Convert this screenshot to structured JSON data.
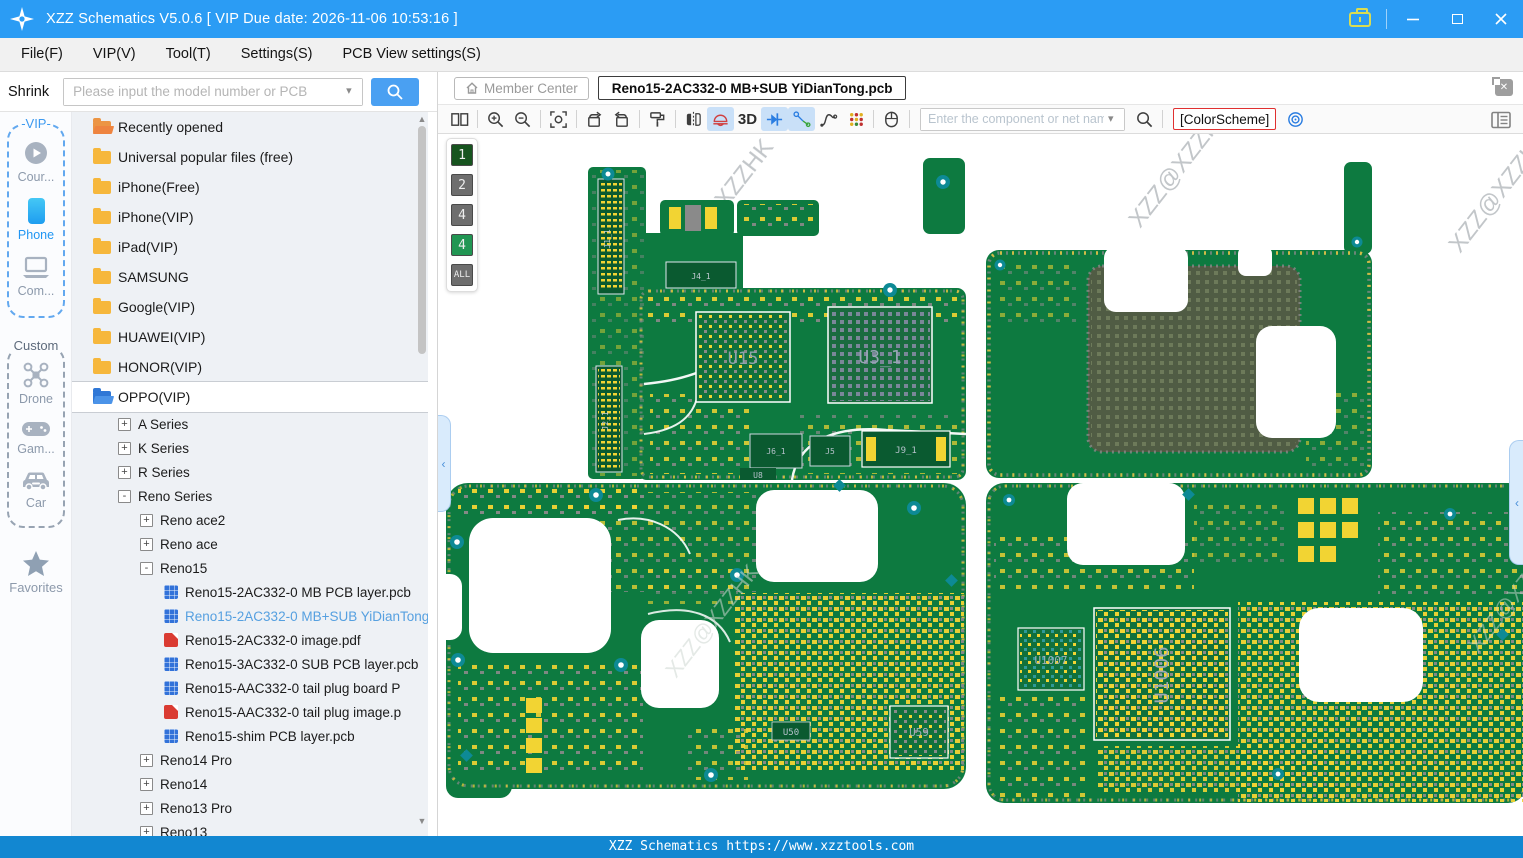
{
  "window": {
    "title": "XZZ Schematics V5.0.6 [ VIP Due date: 2026-11-06 10:53:16 ]"
  },
  "menu": {
    "items": [
      {
        "label": "File(F)"
      },
      {
        "label": "VIP(V)"
      },
      {
        "label": "Tool(T)"
      },
      {
        "label": "Settings(S)"
      },
      {
        "label": "PCB View settings(S)"
      }
    ]
  },
  "search": {
    "shrink": "Shrink",
    "placeholder": "Please input the model number or PCB"
  },
  "header": {
    "member_center": "Member Center",
    "tab": "Reno15-2AC332-0 MB+SUB YiDianTong.pcb"
  },
  "toolbar": {
    "three_d": "3D",
    "net_placeholder": "Enter the component or net nam",
    "color_scheme": "[ColorScheme]"
  },
  "rail": {
    "vip_label": "-VIP-",
    "course": "Cour...",
    "phone": "Phone",
    "computer": "Com...",
    "custom_label": "Custom",
    "drone": "Drone",
    "game": "Gam...",
    "car": "Car",
    "favorites": "Favorites"
  },
  "tree": {
    "items": [
      {
        "label": "Recently opened"
      },
      {
        "label": "Universal popular files (free)"
      },
      {
        "label": "iPhone(Free)"
      },
      {
        "label": "iPhone(VIP)"
      },
      {
        "label": "iPad(VIP)"
      },
      {
        "label": "SAMSUNG"
      },
      {
        "label": "Google(VIP)"
      },
      {
        "label": "HUAWEI(VIP)"
      },
      {
        "label": "HONOR(VIP)"
      },
      {
        "label": "OPPO(VIP)"
      },
      {
        "label": "A Series",
        "expander": "+"
      },
      {
        "label": "K Series",
        "expander": "+"
      },
      {
        "label": "R Series",
        "expander": "+"
      },
      {
        "label": "Reno Series",
        "expander": "-"
      },
      {
        "label": "Reno ace2",
        "expander": "+"
      },
      {
        "label": "Reno ace",
        "expander": "+"
      },
      {
        "label": "Reno15",
        "expander": "-"
      },
      {
        "label": "Reno15-2AC332-0 MB PCB layer.pcb"
      },
      {
        "label": "Reno15-2AC332-0 MB+SUB YiDianTong.pcb"
      },
      {
        "label": "Reno15-2AC332-0 image.pdf"
      },
      {
        "label": "Reno15-3AC332-0 SUB PCB layer.pcb"
      },
      {
        "label": "Reno15-AAC332-0 tail plug board P"
      },
      {
        "label": "Reno15-AAC332-0 tail plug image.p"
      },
      {
        "label": "Reno15-shim PCB layer.pcb"
      },
      {
        "label": "Reno14 Pro",
        "expander": "+"
      },
      {
        "label": "Reno14",
        "expander": "+"
      },
      {
        "label": "Reno13 Pro",
        "expander": "+"
      },
      {
        "label": "Reno13",
        "expander": "+"
      }
    ]
  },
  "layers": {
    "items": [
      {
        "label": "1"
      },
      {
        "label": "2"
      },
      {
        "label": "4"
      },
      {
        "label": "4"
      },
      {
        "label": "ALL"
      }
    ]
  },
  "pcb": {
    "watermark": "XZZ@XZZHK",
    "labels": {
      "u15": "U15",
      "u3_1": "U3_1",
      "j1_1": "J1_1",
      "j2_1": "J2_1",
      "j4_1": "J4_1",
      "j9_1": "J9_1",
      "j6_1": "J6_1",
      "j5": "J5",
      "u8": "U8",
      "u50": "U50",
      "u59": "U59",
      "u1007": "U1007",
      "u1006": "U1006"
    }
  },
  "status": {
    "text": "XZZ Schematics https://www.xzztools.com"
  },
  "colors": {
    "accent": "#2b9cf4",
    "board_green": "#0d7a40",
    "pad_yellow": "#f2d433",
    "status_blue": "#1287d1"
  }
}
